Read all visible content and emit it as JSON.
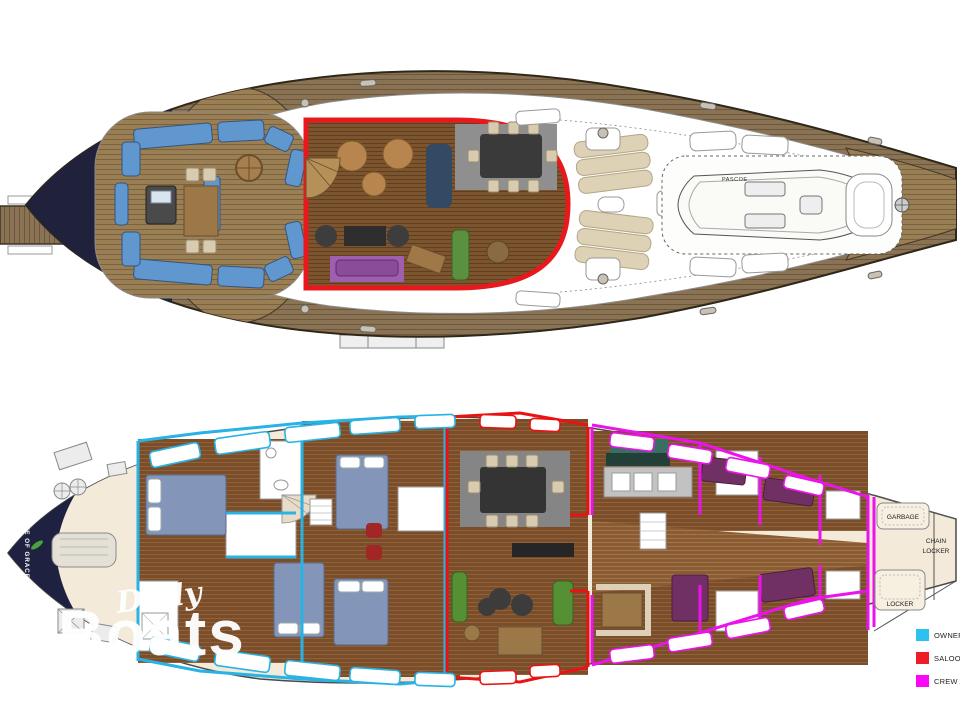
{
  "watermark": {
    "line1": "Daily",
    "line2": "Boats"
  },
  "legend": {
    "items": [
      {
        "label": "OWNERS",
        "color": "#2cc2f0"
      },
      {
        "label": "SALOON",
        "color": "#ee1c24"
      },
      {
        "label": "CREW AREA",
        "color": "#fb06f6"
      }
    ]
  },
  "deck_plan": {
    "tender_label": "PASCOE"
  },
  "interior_plan": {
    "boat_name": "STATE OF GRACE",
    "bow_labels": {
      "garbage": "GARBAGE",
      "chain_line1": "CHAIN",
      "chain_line2": "LOCKER",
      "locker": "LOCKER"
    }
  },
  "zone_colors": {
    "owners": "#29b2e4",
    "saloon": "#ea1314",
    "crew": "#ec12ec"
  }
}
